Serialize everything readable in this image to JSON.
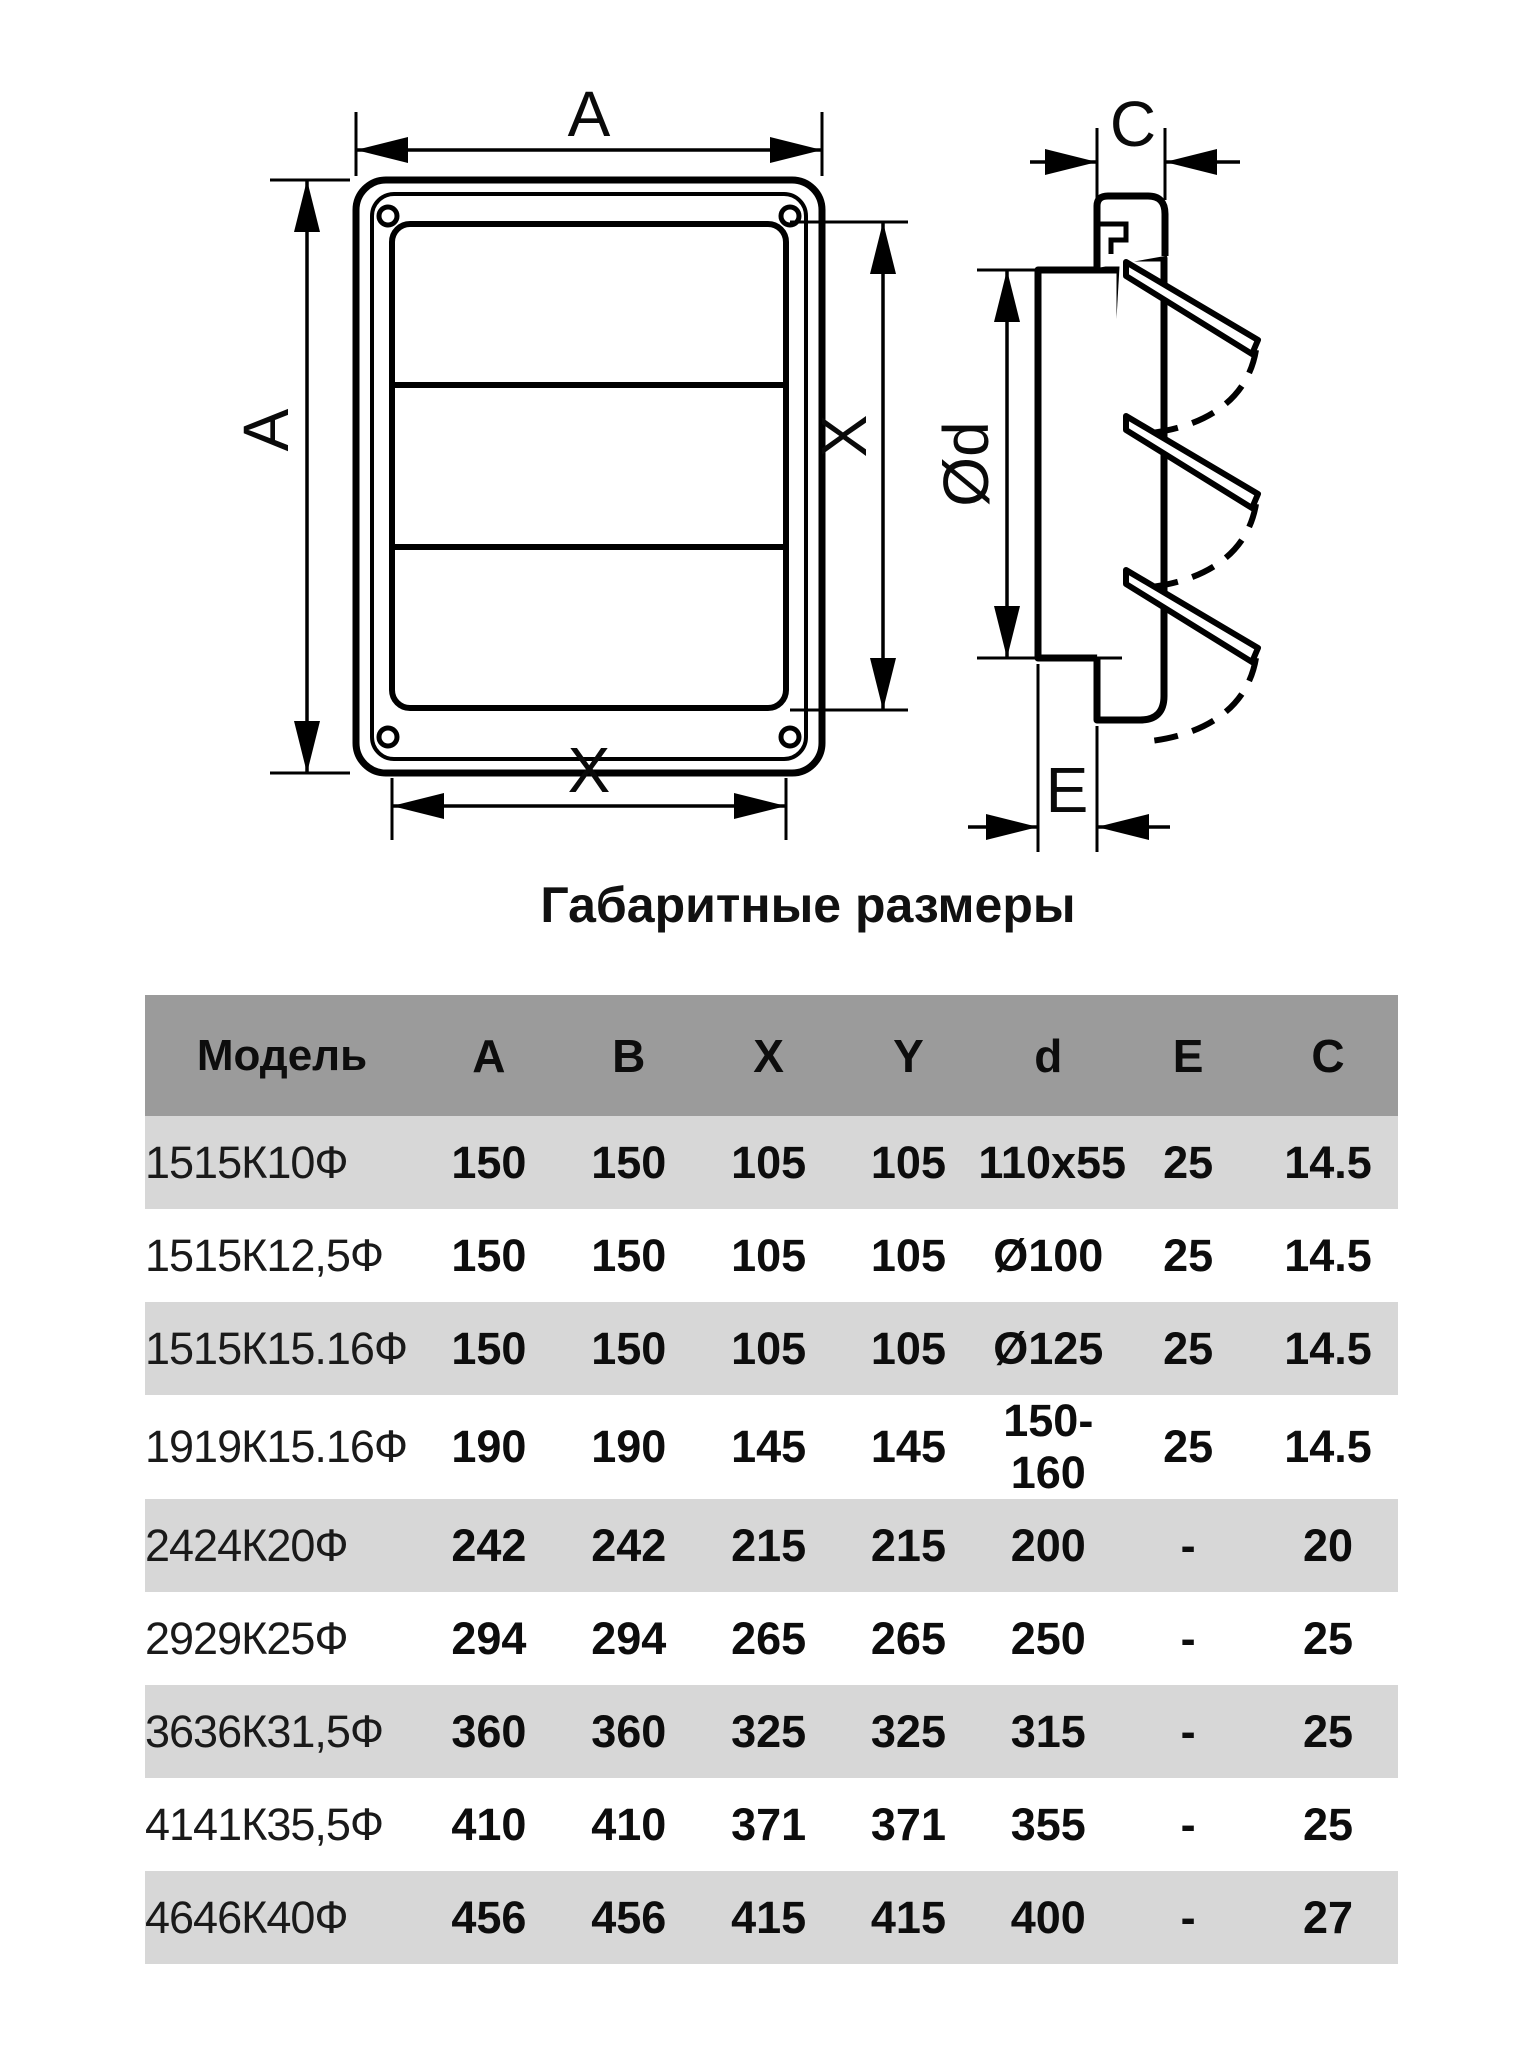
{
  "title": "Габаритные размеры",
  "diagram": {
    "front_view": {
      "top_dim": "A",
      "left_dim": "A",
      "right_dim": "X",
      "bottom_dim": "X"
    },
    "side_view": {
      "top_dim": "C",
      "diameter_dim": "Ød",
      "bottom_dim": "E"
    }
  },
  "table": {
    "headers": [
      "Модель",
      "A",
      "B",
      "X",
      "Y",
      "d",
      "E",
      "C"
    ],
    "rows": [
      {
        "model": "1515К10Ф",
        "values": [
          "150",
          "150",
          "105",
          "105",
          "110x55",
          "25",
          "14.5"
        ]
      },
      {
        "model": "1515К12,5Ф",
        "values": [
          "150",
          "150",
          "105",
          "105",
          "Ø100",
          "25",
          "14.5"
        ]
      },
      {
        "model": "1515К15.16Ф",
        "values": [
          "150",
          "150",
          "105",
          "105",
          "Ø125",
          "25",
          "14.5"
        ]
      },
      {
        "model": "1919К15.16Ф",
        "values": [
          "190",
          "190",
          "145",
          "145",
          "150-160",
          "25",
          "14.5"
        ]
      },
      {
        "model": "2424К20Ф",
        "values": [
          "242",
          "242",
          "215",
          "215",
          "200",
          "-",
          "20"
        ]
      },
      {
        "model": "2929К25Ф",
        "values": [
          "294",
          "294",
          "265",
          "265",
          "250",
          "-",
          "25"
        ]
      },
      {
        "model": "3636К31,5Ф",
        "values": [
          "360",
          "360",
          "325",
          "325",
          "315",
          "-",
          "25"
        ]
      },
      {
        "model": "4141К35,5Ф",
        "values": [
          "410",
          "410",
          "371",
          "371",
          "355",
          "-",
          "25"
        ]
      },
      {
        "model": "4646К40Ф",
        "values": [
          "456",
          "456",
          "415",
          "415",
          "400",
          "-",
          "27"
        ]
      }
    ]
  },
  "colors": {
    "header_bg": "#9b9b9b",
    "shaded_row_bg": "#d7d7d7",
    "line": "#000000"
  }
}
